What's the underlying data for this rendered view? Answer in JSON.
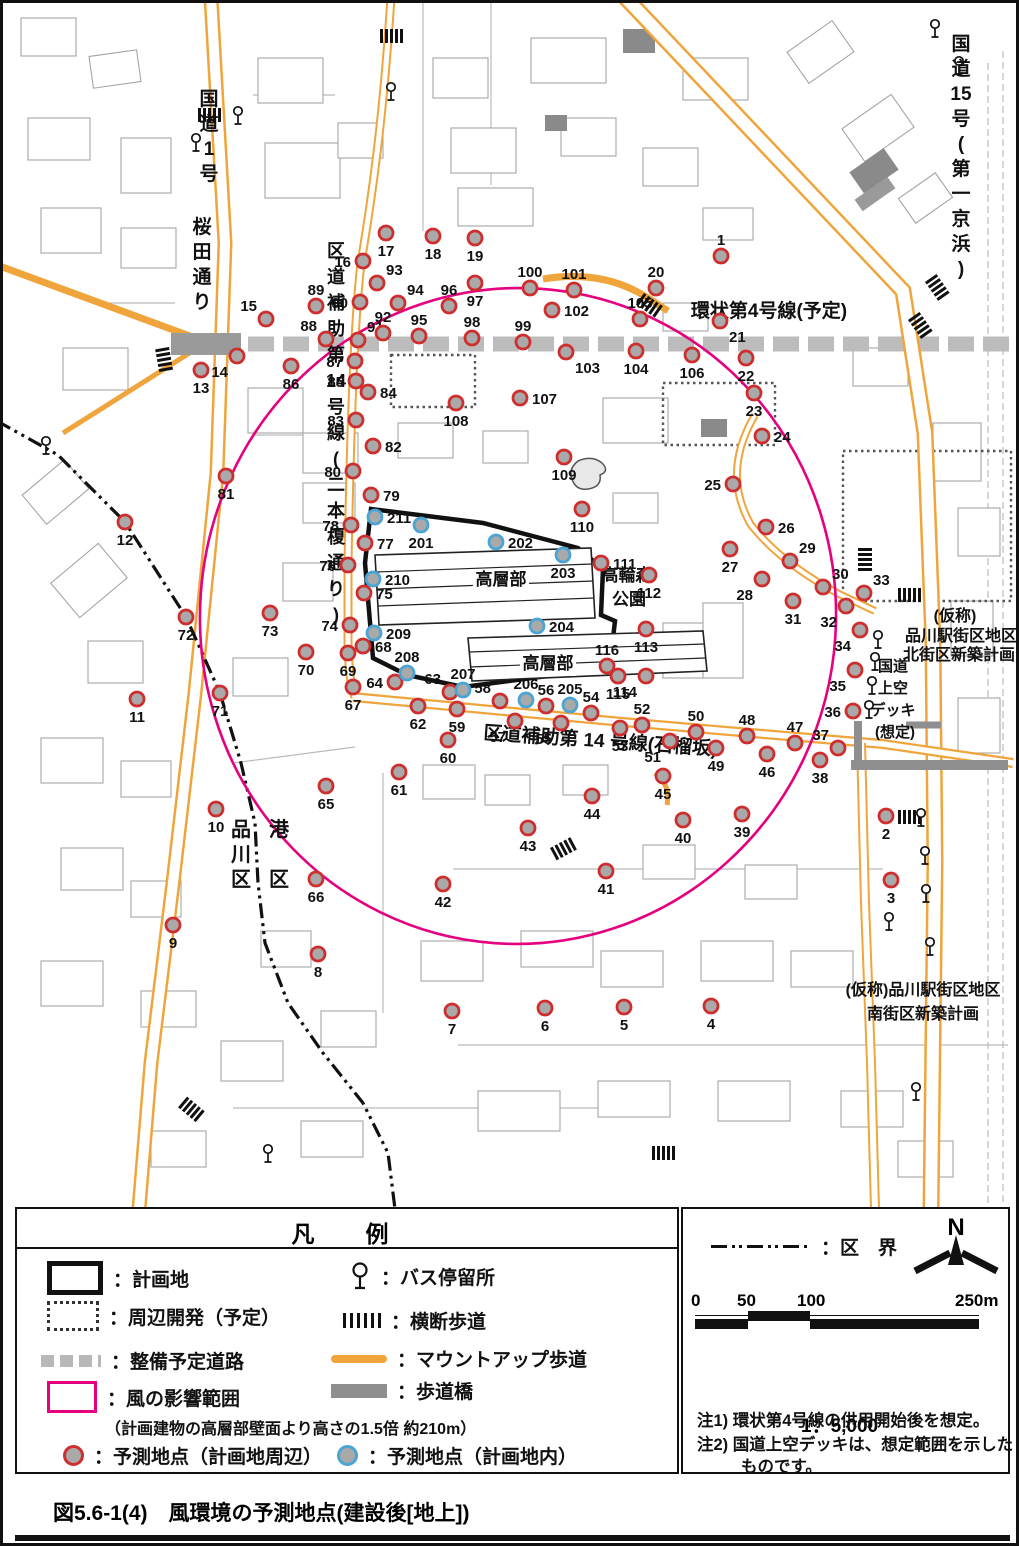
{
  "figure": {
    "caption": "図5.6-1(4)　風環境の予測地点(建設後[地上])"
  },
  "colors": {
    "point_outside_ring": "#cf2e2e",
    "point_inside_ring": "#4aa4d4",
    "point_fill": "#a9a9a9",
    "wind_range": "#e5007f",
    "road_orange": "#f0a53c",
    "planned_road_gray": "#bcbcbc",
    "footbridge_gray": "#8f8f8f"
  },
  "map_labels": {
    "horizontal": [
      {
        "id": "kanjo4",
        "text": "環状第4号線(予定)",
        "x": 766,
        "y": 314,
        "size": 19
      },
      {
        "id": "zakurozaka",
        "text": "区道補助第 14 号線(石榴坂)",
        "x": 597,
        "y": 744,
        "size": 19,
        "rot": 4
      },
      {
        "id": "highrise-upper",
        "text": "高層部",
        "x": 498,
        "y": 582,
        "size": 17,
        "bg": true
      },
      {
        "id": "highrise-lower",
        "text": "高層部",
        "x": 545,
        "y": 666,
        "size": 17,
        "bg": true
      },
      {
        "id": "takanawa-forest-1",
        "text": "高輪森",
        "x": 624,
        "y": 578,
        "size": 17
      },
      {
        "id": "takanawa-forest-2",
        "text": "公園",
        "x": 626,
        "y": 602,
        "size": 17
      },
      {
        "id": "kita-block-1",
        "text": "(仮称)",
        "x": 952,
        "y": 618,
        "size": 16
      },
      {
        "id": "kita-block-2",
        "text": "品川駅街区地区",
        "x": 958,
        "y": 638,
        "size": 16
      },
      {
        "id": "kita-block-3",
        "text": "北街区新築計画",
        "x": 956,
        "y": 657,
        "size": 16
      },
      {
        "id": "deck-1",
        "text": "国道",
        "x": 890,
        "y": 668,
        "size": 15
      },
      {
        "id": "deck-2",
        "text": "上空",
        "x": 890,
        "y": 690,
        "size": 15
      },
      {
        "id": "deck-3",
        "text": "デッキ",
        "x": 890,
        "y": 712,
        "size": 15
      },
      {
        "id": "deck-4",
        "text": "(想定)",
        "x": 892,
        "y": 734,
        "size": 15
      },
      {
        "id": "minami-block-1",
        "text": "(仮称)品川駅街区地区",
        "x": 920,
        "y": 992,
        "size": 16
      },
      {
        "id": "minami-block-2",
        "text": "南街区新築計画",
        "x": 920,
        "y": 1016,
        "size": 16
      }
    ],
    "vertical": [
      {
        "id": "route1",
        "chars": [
          "国",
          "道",
          "1",
          "号"
        ],
        "x": 206,
        "y": 102,
        "dy": 25,
        "size": 19
      },
      {
        "id": "sakurada-dori",
        "chars": [
          "桜",
          "田",
          "通",
          "り"
        ],
        "x": 199,
        "y": 230,
        "dy": 25,
        "size": 19
      },
      {
        "id": "route15",
        "chars": [
          "国",
          "道",
          "15",
          "号",
          "(",
          "第",
          "一",
          "京",
          "浜",
          ")"
        ],
        "x": 958,
        "y": 47,
        "dy": 25,
        "size": 19
      },
      {
        "id": "nihon-enoki",
        "chars": [
          "区",
          "道",
          "補",
          "助",
          "第",
          "14",
          "号",
          "線",
          "(",
          "二",
          "本",
          "榎",
          "通",
          "り",
          ")"
        ],
        "x": 333,
        "y": 254,
        "dy": 26,
        "size": 18
      },
      {
        "id": "shinagawa-ku",
        "chars": [
          "品",
          "川",
          "区"
        ],
        "x": 238,
        "y": 833,
        "dy": 25,
        "size": 20
      },
      {
        "id": "minato-ku",
        "chars": [
          "港",
          "区"
        ],
        "x": 276,
        "y": 833,
        "dy": 50,
        "size": 20
      }
    ]
  },
  "points": {
    "outside": [
      [
        1,
        718,
        253,
        "t"
      ],
      [
        2,
        883,
        813,
        "b"
      ],
      [
        3,
        888,
        877,
        "b"
      ],
      [
        4,
        708,
        1003,
        "b"
      ],
      [
        5,
        621,
        1004,
        "b"
      ],
      [
        6,
        542,
        1005,
        "b"
      ],
      [
        7,
        449,
        1008,
        "b"
      ],
      [
        8,
        315,
        951,
        "b"
      ],
      [
        9,
        170,
        922,
        "b"
      ],
      [
        10,
        213,
        806,
        "b"
      ],
      [
        11,
        134,
        696,
        "b"
      ],
      [
        12,
        122,
        519,
        "b"
      ],
      [
        13,
        198,
        367,
        "b"
      ],
      [
        14,
        234,
        353,
        "bl"
      ],
      [
        15,
        263,
        316,
        "tl"
      ],
      [
        16,
        360,
        258,
        "l"
      ],
      [
        17,
        383,
        230,
        "b"
      ],
      [
        18,
        430,
        233,
        "b"
      ],
      [
        19,
        472,
        235,
        "b"
      ],
      [
        20,
        653,
        285,
        "t"
      ],
      [
        21,
        717,
        318,
        "br"
      ],
      [
        22,
        743,
        355,
        "b"
      ],
      [
        23,
        751,
        390,
        "b"
      ],
      [
        24,
        759,
        433,
        "r"
      ],
      [
        25,
        730,
        481,
        "l"
      ],
      [
        26,
        763,
        524,
        "r"
      ],
      [
        27,
        727,
        546,
        "b"
      ],
      [
        28,
        759,
        576,
        "bl"
      ],
      [
        29,
        787,
        558,
        "tr"
      ],
      [
        30,
        820,
        584,
        "tr"
      ],
      [
        31,
        790,
        598,
        "b"
      ],
      [
        32,
        843,
        603,
        "bl"
      ],
      [
        33,
        861,
        590,
        "tr"
      ],
      [
        34,
        857,
        627,
        "bl"
      ],
      [
        35,
        852,
        667,
        "bl"
      ],
      [
        36,
        850,
        708,
        "l"
      ],
      [
        37,
        835,
        745,
        "tl"
      ],
      [
        38,
        817,
        757,
        "b"
      ],
      [
        39,
        739,
        811,
        "b"
      ],
      [
        40,
        680,
        817,
        "b"
      ],
      [
        41,
        603,
        868,
        "b"
      ],
      [
        42,
        440,
        881,
        "b"
      ],
      [
        43,
        525,
        825,
        "b"
      ],
      [
        44,
        589,
        793,
        "b"
      ],
      [
        45,
        660,
        773,
        "b"
      ],
      [
        46,
        764,
        751,
        "b"
      ],
      [
        47,
        792,
        740,
        "t"
      ],
      [
        48,
        744,
        733,
        "t"
      ],
      [
        49,
        713,
        745,
        "b"
      ],
      [
        50,
        693,
        729,
        "t"
      ],
      [
        51,
        667,
        738,
        "bl"
      ],
      [
        52,
        639,
        722,
        "t"
      ],
      [
        53,
        617,
        725,
        "b"
      ],
      [
        54,
        588,
        710,
        "t"
      ],
      [
        55,
        558,
        720,
        "bl"
      ],
      [
        56,
        543,
        703,
        "t"
      ],
      [
        57,
        512,
        718,
        "bl"
      ],
      [
        58,
        497,
        698,
        "tl"
      ],
      [
        59,
        454,
        706,
        "b"
      ],
      [
        60,
        445,
        737,
        "b"
      ],
      [
        61,
        396,
        769,
        "b"
      ],
      [
        62,
        415,
        703,
        "b"
      ],
      [
        63,
        447,
        689,
        "tl"
      ],
      [
        64,
        392,
        679,
        "l"
      ],
      [
        65,
        323,
        783,
        "b"
      ],
      [
        66,
        313,
        876,
        "b"
      ],
      [
        67,
        350,
        684,
        "b"
      ],
      [
        68,
        360,
        643,
        "r"
      ],
      [
        69,
        345,
        650,
        "b"
      ],
      [
        70,
        303,
        649,
        "b"
      ],
      [
        71,
        217,
        690,
        "b"
      ],
      [
        72,
        183,
        614,
        "b"
      ],
      [
        73,
        267,
        610,
        "b"
      ],
      [
        74,
        347,
        622,
        "l"
      ],
      [
        75,
        361,
        590,
        "r"
      ],
      [
        76,
        345,
        562,
        "l"
      ],
      [
        77,
        362,
        540,
        "r"
      ],
      [
        78,
        348,
        522,
        "l"
      ],
      [
        79,
        368,
        492,
        "r"
      ],
      [
        80,
        350,
        468,
        "l"
      ],
      [
        81,
        223,
        473,
        "b"
      ],
      [
        82,
        370,
        443,
        "r"
      ],
      [
        83,
        353,
        417,
        "l"
      ],
      [
        84,
        365,
        389,
        "r"
      ],
      [
        85,
        353,
        378,
        "l"
      ],
      [
        86,
        288,
        363,
        "b"
      ],
      [
        87,
        352,
        358,
        "l"
      ],
      [
        88,
        323,
        336,
        "tl"
      ],
      [
        89,
        313,
        303,
        "t"
      ],
      [
        90,
        357,
        299,
        "l"
      ],
      [
        91,
        355,
        337,
        "tr"
      ],
      [
        92,
        380,
        330,
        "t"
      ],
      [
        93,
        374,
        280,
        "tr"
      ],
      [
        94,
        395,
        300,
        "tr"
      ],
      [
        95,
        416,
        333,
        "t"
      ],
      [
        96,
        446,
        303,
        "t"
      ],
      [
        97,
        472,
        280,
        "b"
      ],
      [
        98,
        469,
        335,
        "t"
      ],
      [
        99,
        520,
        339,
        "t"
      ],
      [
        100,
        527,
        285,
        "t"
      ],
      [
        101,
        571,
        287,
        "t"
      ],
      [
        102,
        549,
        307,
        "r"
      ],
      [
        103,
        563,
        349,
        "br"
      ],
      [
        104,
        633,
        348,
        "b"
      ],
      [
        105,
        637,
        316,
        "t"
      ],
      [
        106,
        689,
        352,
        "b"
      ],
      [
        107,
        517,
        395,
        "r"
      ],
      [
        108,
        453,
        400,
        "b"
      ],
      [
        109,
        561,
        454,
        "b"
      ],
      [
        110,
        579,
        506,
        "b"
      ],
      [
        111,
        598,
        560,
        "r"
      ],
      [
        112,
        646,
        572,
        "b"
      ],
      [
        113,
        643,
        626,
        "b"
      ],
      [
        114,
        643,
        673,
        "bl"
      ],
      [
        115,
        615,
        673,
        "b"
      ],
      [
        116,
        604,
        663,
        "t"
      ]
    ],
    "inside": [
      [
        201,
        418,
        522,
        "b"
      ],
      [
        202,
        493,
        539,
        "r"
      ],
      [
        203,
        560,
        552,
        "b"
      ],
      [
        204,
        534,
        623,
        "r"
      ],
      [
        205,
        567,
        702,
        "t"
      ],
      [
        206,
        523,
        697,
        "t"
      ],
      [
        207,
        460,
        687,
        "t"
      ],
      [
        208,
        404,
        670,
        "t"
      ],
      [
        209,
        371,
        630,
        "r"
      ],
      [
        210,
        370,
        576,
        "r"
      ],
      [
        211,
        372,
        514,
        "r"
      ]
    ]
  },
  "bus_stops": [
    [
      235,
      112
    ],
    [
      193,
      139
    ],
    [
      388,
      88
    ],
    [
      43,
      442
    ],
    [
      932,
      25
    ],
    [
      956,
      62
    ],
    [
      875,
      636
    ],
    [
      872,
      658
    ],
    [
      869,
      682
    ],
    [
      866,
      706
    ],
    [
      918,
      814
    ],
    [
      922,
      852
    ],
    [
      923,
      890
    ],
    [
      886,
      918
    ],
    [
      927,
      943
    ],
    [
      265,
      1150
    ],
    [
      913,
      1088
    ]
  ],
  "crosswalks": [
    [
      206,
      112,
      0
    ],
    [
      388,
      33,
      0
    ],
    [
      161,
      356,
      80
    ],
    [
      906,
      814,
      0
    ],
    [
      906,
      592,
      0
    ],
    [
      862,
      556,
      90
    ],
    [
      934,
      284,
      55
    ],
    [
      917,
      322,
      55
    ],
    [
      560,
      846,
      -28
    ],
    [
      646,
      302,
      35
    ],
    [
      660,
      1150,
      0
    ],
    [
      188,
      1106,
      40
    ]
  ],
  "legend": {
    "title": "凡　例",
    "left_items": [
      {
        "id": "plan-site",
        "label": "：計画地"
      },
      {
        "id": "surrounding-dev",
        "label": "：周辺開発（予定）"
      },
      {
        "id": "planned-road",
        "label": "：整備予定道路"
      },
      {
        "id": "wind-range",
        "label": "：風の影響範囲",
        "sub": "（計画建物の高層部壁面より高さの1.5倍 約210m）"
      },
      {
        "id": "point-outside",
        "label": "：予測地点（計画地周辺）"
      }
    ],
    "right_items": [
      {
        "id": "bus-stop",
        "label": "：バス停留所"
      },
      {
        "id": "crosswalk",
        "label": "：横断歩道"
      },
      {
        "id": "mountup",
        "label": "：マウントアップ歩道"
      },
      {
        "id": "footbridge",
        "label": "：歩道橋"
      },
      {
        "id": "point-inside",
        "label": "：予測地点（計画地内）"
      }
    ],
    "boundary_label": "：区　界",
    "north_label": "N",
    "scale": {
      "ticks": [
        "0",
        "50",
        "100",
        "250m"
      ],
      "ratio": "1：5,000"
    },
    "notes": [
      "注1) 環状第4号線の供用開始後を想定。",
      "注2) 国道上空デッキは、想定範囲を示した",
      "ものです。"
    ]
  }
}
